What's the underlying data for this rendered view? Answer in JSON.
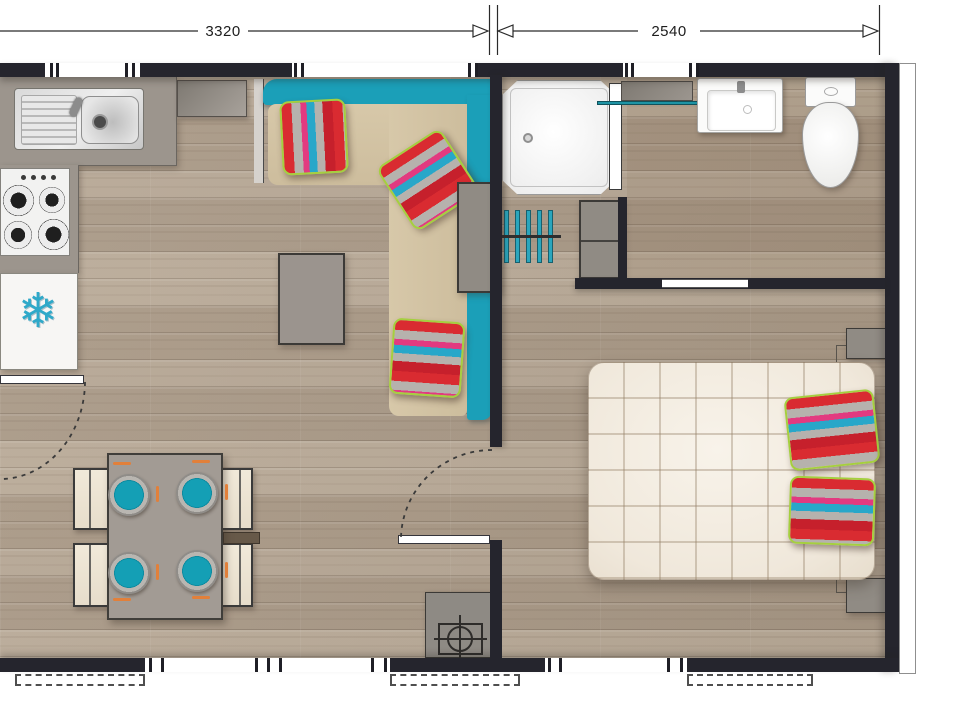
{
  "dimension_labels": {
    "left": "3320",
    "right": "2540"
  },
  "icons": {
    "fridge_snowflake_glyph": "❄"
  },
  "colors": {
    "wall": "#25252d",
    "sofa_teal": "#1b9fb8",
    "sofa_seat_tan": "#d2c2a3",
    "bench_cream": "#ede5d4",
    "plate_teal": "#149fb5",
    "cutlery_orange": "#e2803a",
    "fridge_snowflake_blue": "#2fa9c9",
    "wardrobe_teal": "#2aa6bd",
    "towel_rail_teal": "#1d93a4",
    "mattress_cream": "#f2ebe0",
    "pillow_red": "#d92b31",
    "pillow_blue": "#28a7c9",
    "pillow_pink": "#e23a80",
    "pillow_silver": "#b6b2ad",
    "pillow_lime": "#a5cf3f",
    "floor_wood": "#b2a28f"
  }
}
